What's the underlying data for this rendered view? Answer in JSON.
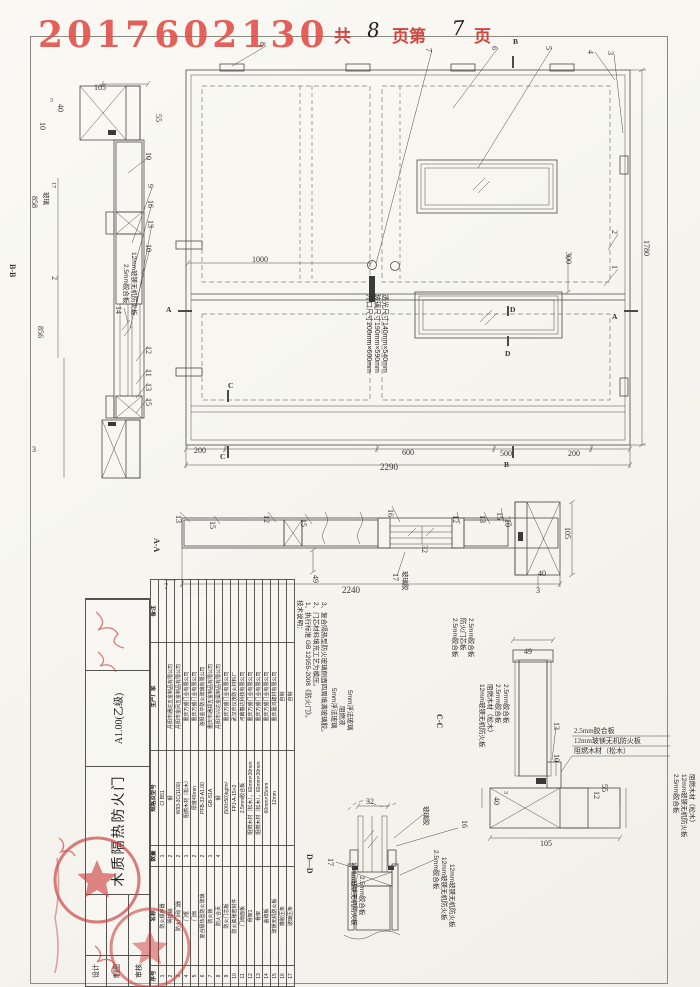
{
  "header": {
    "serial": "2017602130",
    "pages": {
      "prefix": "共",
      "total": "8",
      "mid": "页第",
      "current": "7",
      "suffix": "页"
    }
  },
  "elevation": {
    "dims": {
      "total_width": "2290",
      "seg_left": "200",
      "seg_mid1": "600",
      "seg_mid2": "500",
      "seg_right": "200",
      "height": "1780",
      "lock_offset": "1000",
      "vision_offset": "300"
    },
    "glass_note": [
      "开口尺寸200mm×600mm",
      "玻璃尺寸190mm×590mm",
      "透光尺寸140mm×540mm"
    ],
    "callouts": {
      "c1": "1",
      "c2": "2",
      "c3": "3",
      "c4": "4",
      "c5": "5",
      "c6": "6",
      "c7": "7",
      "c8": "8"
    },
    "markers": {
      "a_left": "A",
      "a_right": "A",
      "b_top": "B",
      "b_bottom": "B",
      "c_top": "C",
      "c_bottom": "C",
      "d_top": "D",
      "d_bottom": "D"
    }
  },
  "section_bb": {
    "label": "B-B",
    "dims": {
      "d105": "105",
      "d55": "55",
      "d40": "40",
      "d10": "10",
      "d3": "3",
      "d17": "17",
      "d2": "2",
      "d858": "858",
      "d856": "856",
      "d3b": "3"
    },
    "callouts": {
      "c10a": "10",
      "c9": "9",
      "c16": "16",
      "c13a": "13",
      "c10b": "10",
      "c14": "14",
      "c12": "12",
      "c11": "11",
      "c13b": "13",
      "c15": "15"
    },
    "ann14": [
      "2.5mm胶合板",
      "12mm玻镁无机防火板"
    ],
    "glass": "玻璃"
  },
  "section_aa": {
    "label": "A-A",
    "dims": {
      "d7": "7",
      "d49": "49",
      "d32": "32",
      "d2240": "2240",
      "d105": "105",
      "d40": "40",
      "d3": "3"
    },
    "callouts": [
      "13",
      "15",
      "12",
      "15",
      "16",
      "17",
      "12",
      "13",
      "15",
      "10"
    ],
    "glue": "玻璃胶"
  },
  "detail_cc": {
    "label": "C-C",
    "dims": {
      "d49": "49",
      "d3": "3",
      "d40": "40",
      "d105": "105",
      "d55": "55",
      "d12": "12"
    },
    "callouts": {
      "c13": "13",
      "c10": "10"
    },
    "left_ann1": [
      "2.5mm胶合板",
      "防火门芯板",
      "2.5mm胶合板"
    ],
    "left_ann2": [
      "12mm玻镁无机防火板",
      "阻燃木材（松木）",
      "2.5mm胶合板",
      "2.5mm胶合板"
    ],
    "right_ann": [
      "2.5mm胶合板",
      "12mm玻镁无机防火板",
      "阻燃木材（松木）"
    ],
    "right_edge_ann": [
      "2.5mm胶合板",
      "12mm玻镁无机防火板",
      "阻燃木材（松木）"
    ]
  },
  "detail_dd": {
    "label": "D—D",
    "dims": {
      "d32": "32"
    },
    "callouts": {
      "c16": "16",
      "c17": "17"
    },
    "glue": "玻璃胶",
    "left_ann": [
      "5mm浮法玻璃",
      "阻燃液",
      "5mm浮法玻璃"
    ],
    "bottom_left_ann": [
      "12mm玻镁无机防火板",
      "2.5mm胶合板"
    ],
    "right_ann": [
      "2.5mm胶合板",
      "12mm玻镁无机防火板",
      "12mm玻镁无机防火板"
    ]
  },
  "notes": {
    "title": "技术说明：",
    "items": [
      "1、执行标准 GB 12955-2008《防火门》。",
      "2、门芯材料填充工艺为模压。",
      "3、复合隔热型防火玻璃侧面四周填满玻璃胶。"
    ]
  },
  "bom": {
    "headers": [
      "序号",
      "名称",
      "数量",
      "规格及型号",
      "生产厂家",
      "备注"
    ],
    "rows": [
      [
        "1",
        "防火顺序器",
        "1",
        "CI B51",
        "",
        ""
      ],
      [
        "2",
        "明插销",
        "2",
        "钢",
        "丹阳市通达五金制品有限公司",
        ""
      ],
      [
        "3",
        "防火门闭门器",
        "2",
        "W93-3C(1100)",
        "丹阳市金凤五金制品有限公司",
        ""
      ],
      [
        "4",
        "门框",
        "1",
        "阻燃木材（松木）",
        "重庆万盛门业有限公司",
        ""
      ],
      [
        "5",
        "门扇",
        "2",
        "厚度49mm",
        "重庆万盛门业有限公司",
        ""
      ],
      [
        "6",
        "复合隔热型防火玻璃",
        "2",
        "PFB-32-A1.00",
        "洛阳金平防火玻璃有限公司",
        ""
      ],
      [
        "7",
        "防火锁",
        "1",
        "GB-S1A",
        "重庆市通郑五金制品有限公司",
        ""
      ],
      [
        "8",
        "防火合页",
        "4",
        "钢",
        "丹阳市兴达金属制品有限公司",
        ""
      ],
      [
        "9",
        "防火门芯板",
        "",
        "(500±50)kg/m³",
        "重庆万盛门业有限公司",
        ""
      ],
      [
        "10",
        "防火膨胀密封件",
        "",
        "FPJ-A-15×2",
        "武汉市仪茂防火材料厂",
        ""
      ],
      [
        "11",
        "门扇面板",
        "",
        "2.5mm胶合板",
        "河南春达科技有限公司",
        ""
      ],
      [
        "12",
        "骨架1",
        "",
        "阻燃木材（松木），60mm×30mm",
        "重庆万盛门业有限公司",
        ""
      ],
      [
        "13",
        "骨架",
        "",
        "阻燃木材（松木），60mm×30mm",
        "重庆万盛门业有限公司",
        ""
      ],
      [
        "14",
        "盖缝板",
        "",
        "60mm×15mm",
        "重庆万盛门业有限公司",
        ""
      ],
      [
        "15",
        "玻镁无机防火板",
        "",
        "12mm",
        "重庆嘉鸿建材有限公司",
        ""
      ],
      [
        "16",
        "橡胶压条",
        "",
        "",
        "自制",
        ""
      ],
      [
        "17",
        "玻璃压条",
        "",
        "",
        "自制",
        ""
      ]
    ]
  },
  "title_block": {
    "sig_labels": [
      "设计",
      "制图",
      "审核"
    ],
    "product": "木质隔热防火门",
    "drawing_no": "A1.00(乙级)"
  },
  "colors": {
    "stamp_red": "#d5453f",
    "line": "#4a4a46"
  }
}
